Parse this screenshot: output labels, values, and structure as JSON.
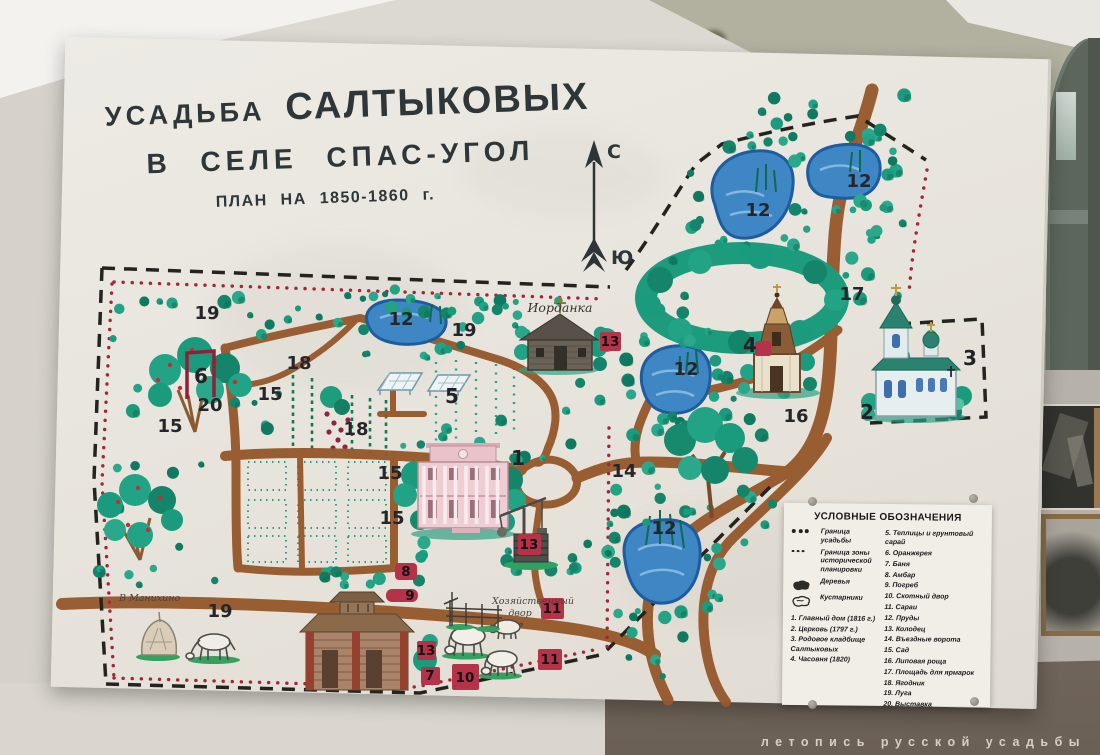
{
  "scene": {
    "watermark": "летопись русской усадьбы"
  },
  "title": {
    "estate_small": "УСАДЬБА",
    "estate_big": "САЛТЫКОВЫХ",
    "village": "В СЕЛЕ  СПАС-УГОЛ",
    "plan": "ПЛАН НА 1850-1860 г."
  },
  "compass": {
    "north": "С",
    "south": "Ю"
  },
  "map": {
    "handwritten": {
      "iordanka": "Иорданка",
      "khozdvor_1": "Хозяйственный",
      "khozdvor_2": "двор",
      "manikhino": "В Манихино"
    },
    "cemetery_cross": "✝",
    "numbers": {
      "meadow_nw": "19",
      "meadow_c": "19",
      "meadow_s": "19",
      "garden_w": "15",
      "garden_m": "15",
      "garden_e1": "15",
      "garden_e2": "15",
      "berry_n": "18",
      "berry_s": "18",
      "pond_ne1": "12",
      "pond_ne2": "12",
      "pond_e": "12",
      "pond_nw": "12",
      "pond_s": "12",
      "fair": "17",
      "linden": "16",
      "gates": "14",
      "main_house": "1",
      "church": "2",
      "cemetery": "3",
      "chapel": "4",
      "greenhouse": "5",
      "orangery": "6",
      "exhibition": "20"
    },
    "markers": {
      "well_iordanka": "13",
      "well_house": "13",
      "ambar": "8",
      "pogreb": "9",
      "kolodets_s": "13",
      "banya": "7",
      "skotny": "10",
      "saray_n": "11",
      "saray_s": "11"
    }
  },
  "legend": {
    "title": "УСЛОВНЫЕ ОБОЗНАЧЕНИЯ",
    "symbols": [
      {
        "icon": "boundary-dots",
        "label": "Граница усадьбы"
      },
      {
        "icon": "boundary-dots-small",
        "label": "Граница зоны исторической планировки"
      },
      {
        "icon": "tree-blob",
        "label": "Деревья"
      },
      {
        "icon": "shrub-blob",
        "label": "Кустарники"
      }
    ],
    "items_left": [
      "1. Главный дом (1816 г.)",
      "2. Церковь (1797 г.)",
      "3. Родовое кладбище Салтыковых",
      "4. Часовня (1820)"
    ],
    "items_right": [
      "5. Теплицы и грунтовый сарай",
      "6. Оранжерея",
      "7. Баня",
      "8. Амбар",
      "9. Погреб",
      "10. Скотный двор",
      "11. Сараи",
      "12. Пруды",
      "13. Колодец",
      "14. Въездные ворота",
      "15. Сад",
      "16. Липовая роща",
      "17. Площадь для ярмарок",
      "18. Ягодник",
      "19. Луга",
      "20. Выставка"
    ]
  }
}
